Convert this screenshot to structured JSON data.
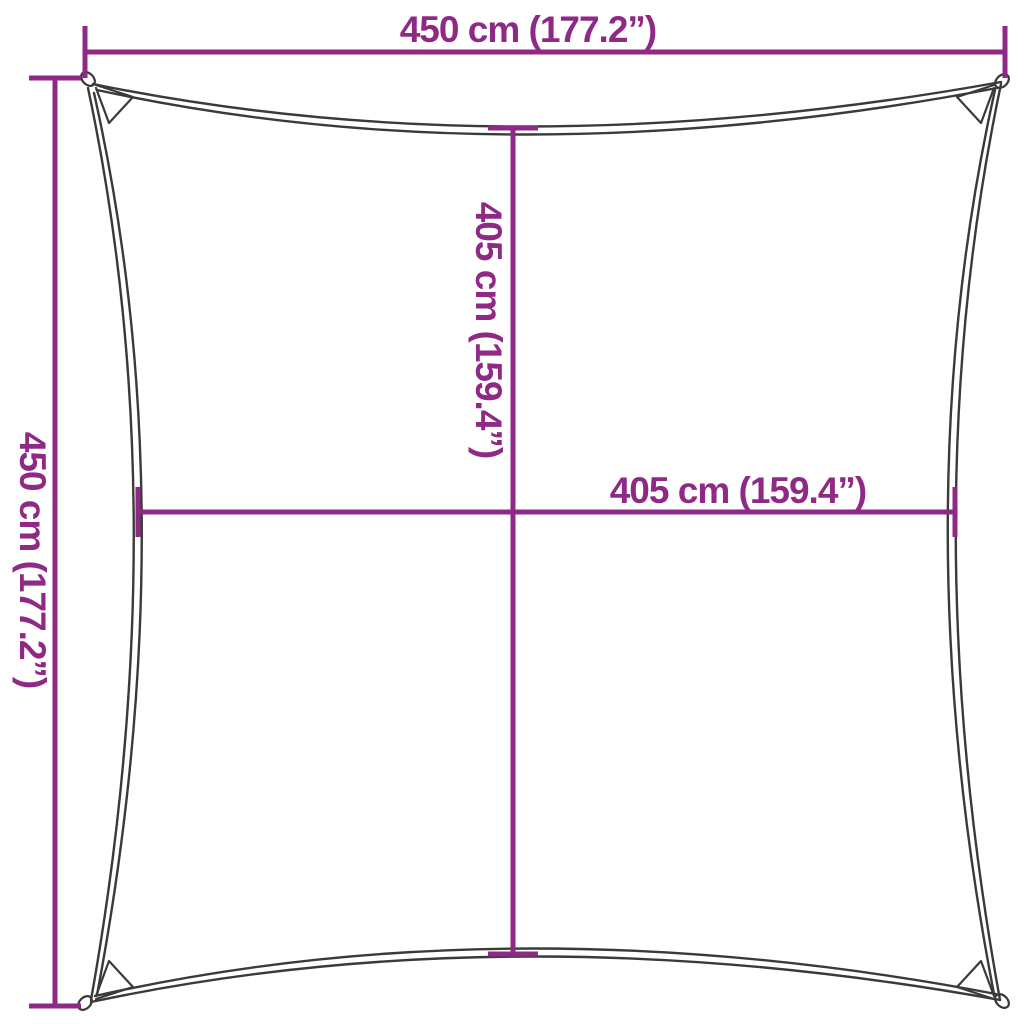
{
  "background": "#FFFFFF",
  "colors": {
    "dimension_accent": "#8E2A86",
    "sail_outline": "#3A3A3A"
  },
  "diagram": {
    "type": "product-dimension-diagram",
    "subject": "square shade sail with concave edges and corner rings"
  },
  "dimensions": {
    "top": {
      "label": "450 cm (177.2”)",
      "value_cm": 450,
      "value_in": 177.2,
      "orientation": "horizontal"
    },
    "left": {
      "label": "450 cm (177.2”)",
      "value_cm": 450,
      "value_in": 177.2,
      "orientation": "vertical"
    },
    "inner_vertical": {
      "label": "405 cm (159.4”)",
      "value_cm": 405,
      "value_in": 159.4,
      "orientation": "vertical"
    },
    "inner_horizontal": {
      "label": "405 cm (159.4”)",
      "value_cm": 405,
      "value_in": 159.4,
      "orientation": "horizontal"
    }
  }
}
